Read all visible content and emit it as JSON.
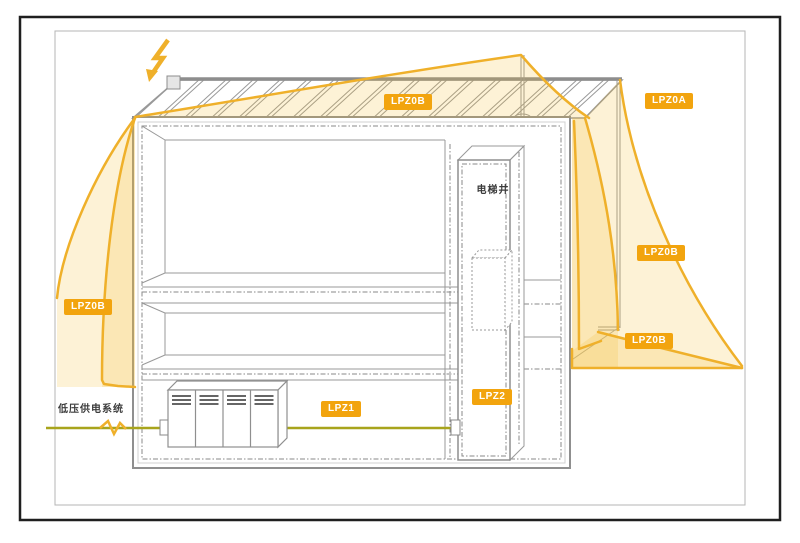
{
  "diagram": {
    "type": "lightning-protection-zones-building-diagram",
    "badges": [
      {
        "id": "lpz0b-roof",
        "label": "LPZ0B"
      },
      {
        "id": "lpz0a-right",
        "label": "LPZ0A"
      },
      {
        "id": "lpz0b-right-upper",
        "label": "LPZ0B"
      },
      {
        "id": "lpz0b-right-lower",
        "label": "LPZ0B"
      },
      {
        "id": "lpz0b-left",
        "label": "LPZ0B"
      },
      {
        "id": "lpz1",
        "label": "LPZ1"
      },
      {
        "id": "lpz2",
        "label": "LPZ2"
      }
    ],
    "labels": {
      "elevator_shaft": "电梯井",
      "lv_power_system": "低压供电系统"
    },
    "icons": [
      {
        "name": "lightning-bolt-icon"
      },
      {
        "name": "air-terminal-rod"
      },
      {
        "name": "down-conductor"
      }
    ],
    "colors": {
      "badge_bg": "#F2A40E",
      "zone_stroke": "#EFB02A",
      "zone_fill": "#F6BE30",
      "cable": "#A8A41C",
      "outline": "#999999",
      "frame_outer": "#1f1f1f",
      "frame_inner": "#b5b5b5",
      "background": "#ffffff"
    }
  }
}
